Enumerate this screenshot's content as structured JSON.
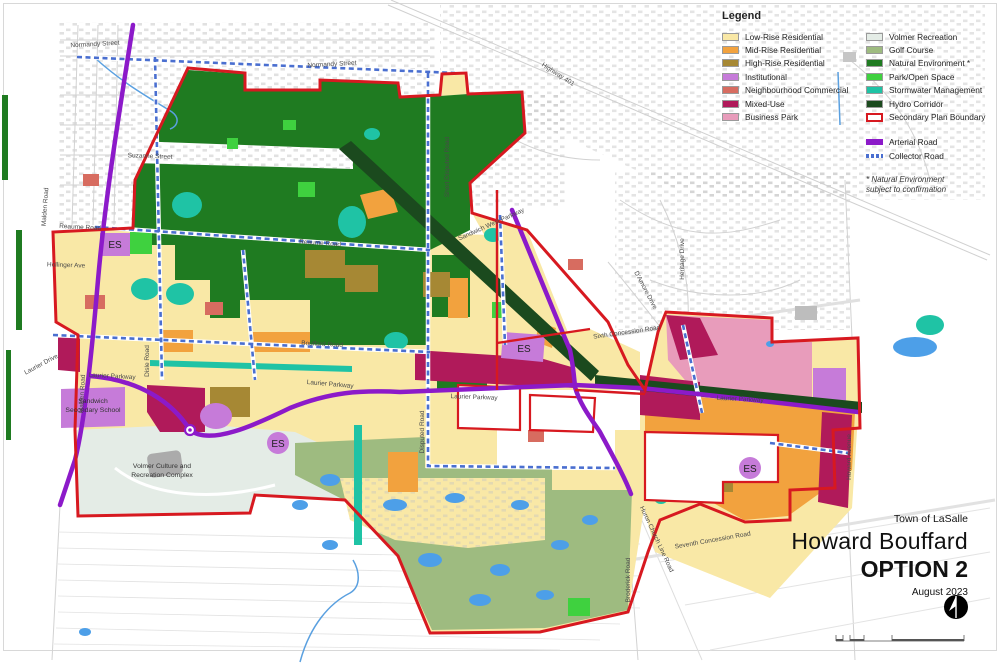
{
  "legend": {
    "title": "Legend",
    "items_left": [
      {
        "label": "Low-Rise Residential",
        "color": "#F9E8A6"
      },
      {
        "label": "Mid-Rise Residential",
        "color": "#F2A23E"
      },
      {
        "label": "High-Rise Residential",
        "color": "#A68834"
      },
      {
        "label": "Institutional",
        "color": "#C67BD9"
      },
      {
        "label": "Neighbourhood Commercial",
        "color": "#D76C60"
      },
      {
        "label": "Mixed-Use",
        "color": "#B01A5A"
      },
      {
        "label": "Business Park",
        "color": "#E89CBB"
      }
    ],
    "items_right": [
      {
        "label": "Volmer Recreation",
        "color": "#E4ECE6"
      },
      {
        "label": "Golf Course",
        "color": "#9EBB80"
      },
      {
        "label": "Natural Environment *",
        "color": "#1F7B21"
      },
      {
        "label": "Park/Open Space",
        "color": "#3FD13F"
      },
      {
        "label": "Stormwater Management",
        "color": "#1FC3A5"
      },
      {
        "label": "Hydro Corridor",
        "color": "#1B4A1E"
      },
      {
        "label": "Secondary Plan Boundary",
        "color": "#D71920"
      }
    ],
    "roads": [
      {
        "label": "Arterial Road",
        "color": "#8C1AC9"
      },
      {
        "label": "Collector Road",
        "color": "#4A6FD0"
      }
    ],
    "note1": "* Natural Environment",
    "note2": "subject to confirmation"
  },
  "title_block": {
    "municipality": "Town of LaSalle",
    "title": "Howard Bouffard",
    "option": "OPTION 2",
    "date": "August 2023"
  },
  "map": {
    "es_label": "ES",
    "street_labels": [
      {
        "text": "Normandy Street"
      },
      {
        "text": "Normandy Street"
      },
      {
        "text": "Suzanne Street"
      },
      {
        "text": "Reaume Road"
      },
      {
        "text": "Reaume Road"
      },
      {
        "text": "Hollinger Ave"
      },
      {
        "text": "Malden Road"
      },
      {
        "text": "Malden Road"
      },
      {
        "text": "Laurier Drive"
      },
      {
        "text": "Laurier Parkway"
      },
      {
        "text": "Laurier Parkway"
      },
      {
        "text": "Laurier Parkway"
      },
      {
        "text": "Laurier Parkway"
      },
      {
        "text": "Bouffard Road"
      },
      {
        "text": "Disle Road"
      },
      {
        "text": "Disputed Road"
      },
      {
        "text": "Short Disputed Road"
      },
      {
        "text": "Sandwich West Parkway"
      },
      {
        "text": "Highway 401"
      },
      {
        "text": "Sixth Concession Road"
      },
      {
        "text": "Seventh Concession Road"
      },
      {
        "text": "Huron Church Line Road"
      },
      {
        "text": "Broderick Road"
      },
      {
        "text": "Howard Avenue"
      },
      {
        "text": "Heritage Drive"
      },
      {
        "text": "D'Amore Drive"
      }
    ],
    "facilities": {
      "school_line1": "Sandwich",
      "school_line2": "Secondary School",
      "volmer_line1": "Volmer Culture and",
      "volmer_line2": "Recreation Complex"
    },
    "colors": {
      "boundary": "#D71920",
      "arterial_road": "#8C1AC9",
      "collector_road": "#4A6FD0",
      "low_rise": "#F9E8A6",
      "mid_rise": "#F2A23E",
      "high_rise": "#A68834",
      "institutional": "#C67BD9",
      "neighbourhood_commercial": "#D76C60",
      "mixed_use": "#B01A5A",
      "business_park": "#E89CBB",
      "volmer_recreation": "#E4ECE6",
      "golf_course": "#9EBB80",
      "natural_environment": "#1F7B21",
      "park_open_space": "#3FD13F",
      "stormwater": "#1FC3A5",
      "hydro_corridor": "#1B4A1E",
      "water": "#4D9FE8"
    }
  }
}
